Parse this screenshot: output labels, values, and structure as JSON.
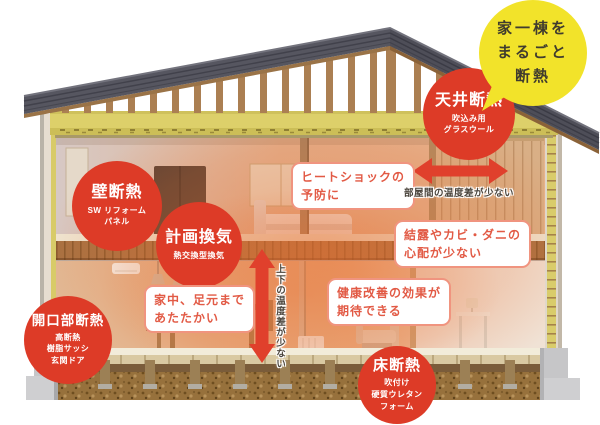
{
  "title_badge": {
    "lines": [
      "家一棟を",
      "まるごと",
      "断熱"
    ]
  },
  "insulation_labels": {
    "ceiling": {
      "title": "天井断熱",
      "sub": [
        "吹込み用",
        "グラスウール"
      ]
    },
    "wall": {
      "title": "壁断熱",
      "sub": [
        "SW リフォーム",
        "パネル"
      ]
    },
    "ventilation": {
      "title": "計画換気",
      "sub": [
        "熱交換型換気"
      ]
    },
    "opening": {
      "title": "開口部断熱",
      "sub": [
        "高断熱",
        "樹脂サッシ",
        "玄関ドア"
      ]
    },
    "floor": {
      "title": "床断熱",
      "sub": [
        "吹付け",
        "硬質ウレタン",
        "フォーム"
      ]
    }
  },
  "benefit_notes": {
    "heat_shock": {
      "lines": [
        "ヒートショックの",
        "予防に"
      ]
    },
    "condensation": {
      "lines": [
        "結露やカビ・ダニの",
        "心配が少ない"
      ]
    },
    "warmth": {
      "lines": [
        "家中、足元まで",
        "あたたかい"
      ]
    },
    "health": {
      "lines": [
        "健康改善の効果が",
        "期待できる"
      ]
    }
  },
  "temperature_notes": {
    "between_rooms": "部屋間の温度差が少ない",
    "vertical": "上下の温度差が少ない"
  },
  "colors": {
    "label_red": "#dd3b27",
    "arrow_red": "#e0402c",
    "benefit_text_red": "#e25a45",
    "benefit_border": "#f0947f",
    "badge_yellow": "#f2e32a",
    "badge_text": "#403c2e",
    "note_text": "#4a443c",
    "insulation_yellow": "#ddd06a",
    "roof_gray": "#565660"
  }
}
